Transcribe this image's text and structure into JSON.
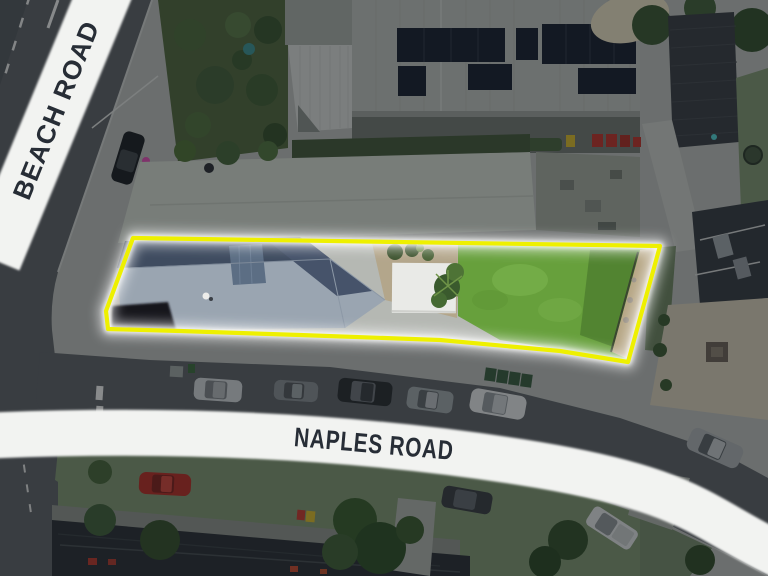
{
  "title": "Aerial property photo with highlighted lot at Beach Road / Naples Road corner",
  "labels": {
    "beach_road": "BEACH ROAD",
    "naples_road": "NAPLES ROAD"
  },
  "colors": {
    "footpath": "#b5b8b3",
    "road_asphalt": "#5d6165",
    "lawn_green": "#67a03c",
    "roof_light": "#9aa5b1",
    "roof_dark": "#3f4c60",
    "outline_yellow": "#eef000",
    "outline_glow": "#ffffff",
    "label_band": "#f2f3f1",
    "label_text": "#272d36",
    "dim_overlay": "#0a0d12",
    "grass_verge": "#7e9370",
    "tree_green": "#46603a",
    "solar_panel": "#1c2330",
    "shed_white": "#e9eae7"
  },
  "scene": {
    "highlighted_property": {
      "outlined": true,
      "visible_contents": [
        "hip-roof-house",
        "white-shed",
        "palm-tree",
        "backyard-lawn",
        "side-driveway"
      ]
    },
    "roads": [
      "Beach Road",
      "Naples Road"
    ],
    "parked_cars": {
      "naples_north_side": 5,
      "naples_south_side": 2,
      "naples_far_east": 1,
      "red_car_south_west": 1,
      "beach_road": 1
    },
    "surroundings": [
      "solar-panel-buildings",
      "warehouse-roof",
      "dark-roof-houses",
      "courtyard",
      "railway-corridor",
      "street-trees"
    ]
  }
}
